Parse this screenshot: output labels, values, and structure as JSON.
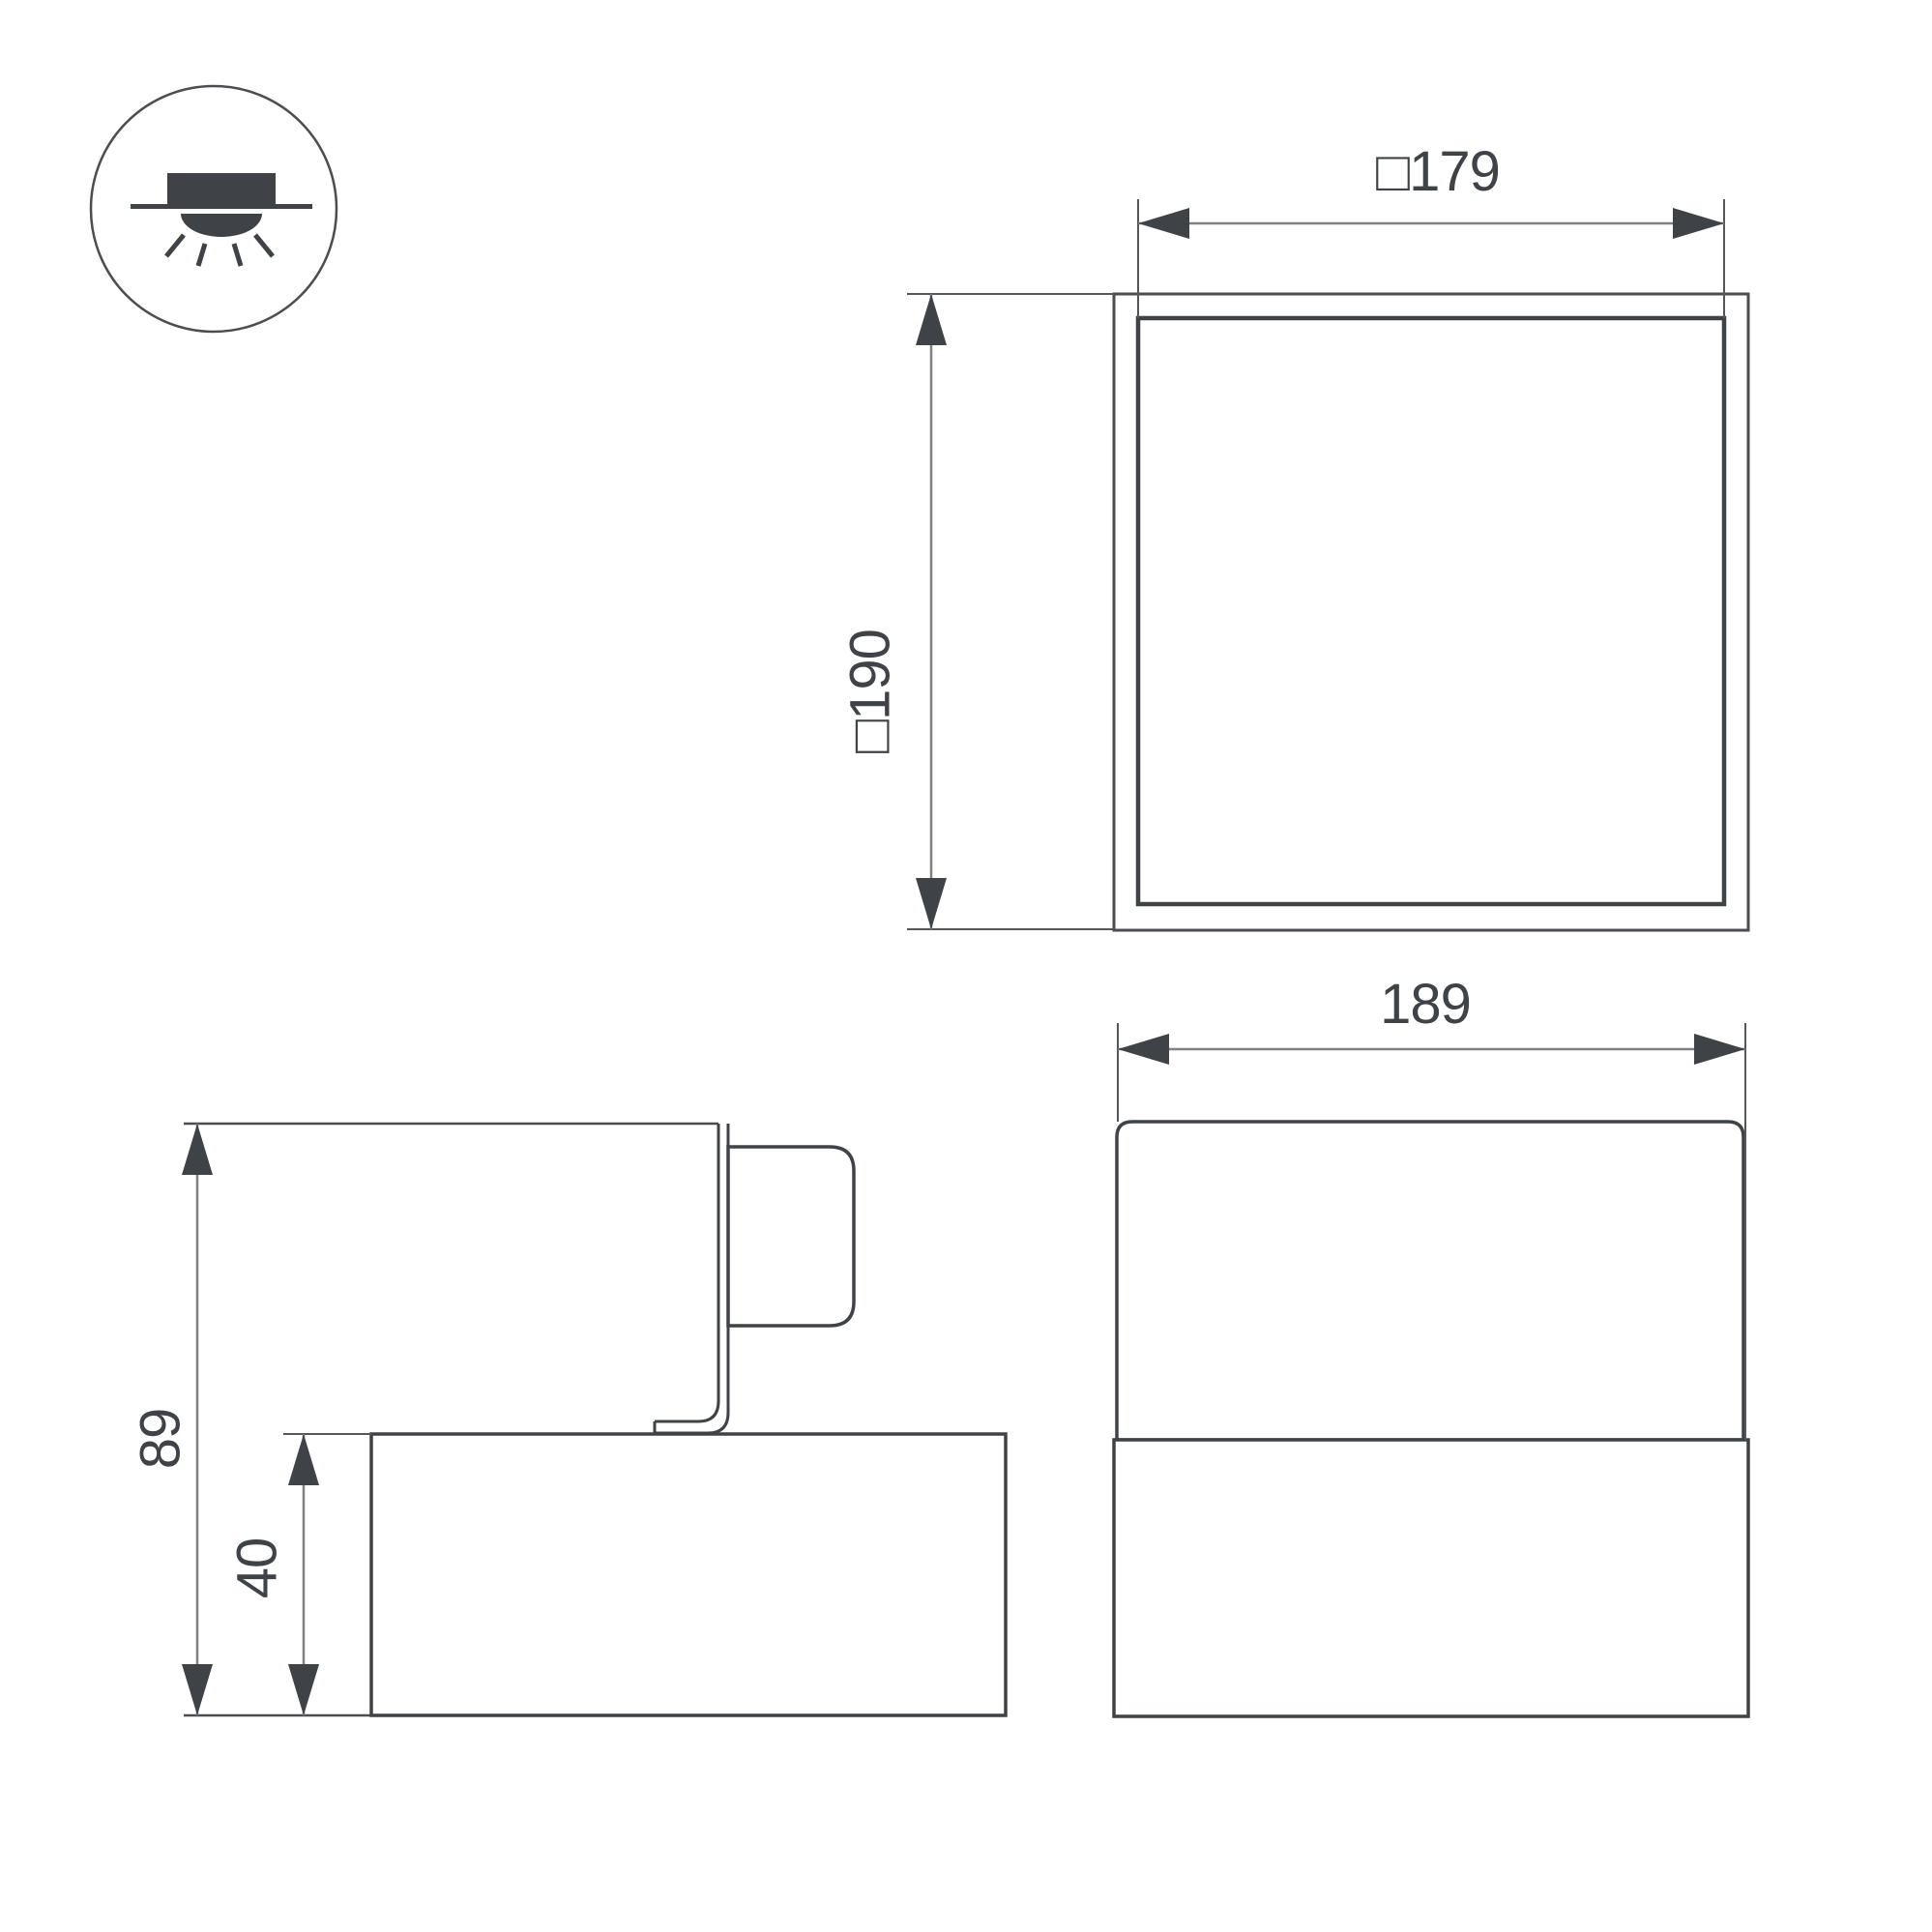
{
  "drawing": {
    "kind": "luminaire-dimension-drawing",
    "colors": {
      "ink": "#3f4246",
      "frame": "#4b4d50",
      "extension_line": "#54565a",
      "dimension_line": "#7e8083",
      "background": "#ffffff"
    },
    "mount_icon": {
      "name": "semi-recessed-downlight-icon",
      "meaning": "recessed ceiling mounting with downward light"
    },
    "top_view": {
      "inner_dim_label": "□179",
      "outer_dim_label": "□190"
    },
    "front_view": {
      "width_dim_label": "189"
    },
    "side_view": {
      "total_height_dim_label": "89",
      "base_height_dim_label": "40"
    },
    "dimensions_mm": {
      "opening_square": 179,
      "outer_square": 190,
      "body_width": 189,
      "total_height": 89,
      "base_height": 40
    }
  }
}
